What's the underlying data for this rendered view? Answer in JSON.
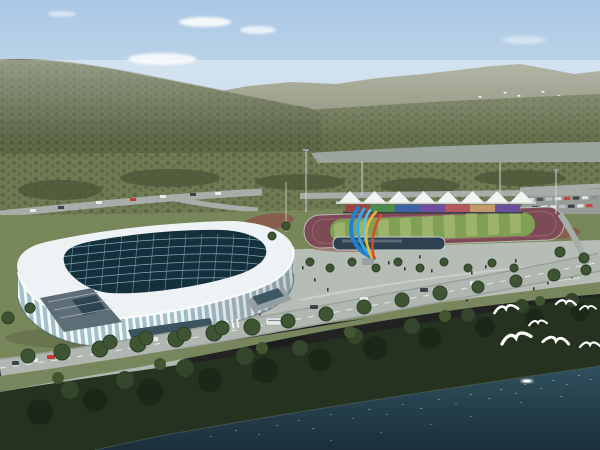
{
  "canvas": {
    "width": 600,
    "height": 450
  },
  "scene": {
    "description": "Aerial architectural rendering of a riverside sports complex: a white ribbed indoor arena with dark glass grid skylight, an outdoor athletics track with colorful grandstand and white tent canopies, a ribbon sculpture on a plaza, forested mountains behind, a river strip, dark shoreline trees and water in front with white birds",
    "clouds_count": 5,
    "distant_flock_count": 16,
    "foreground_birds_count": 7,
    "tents_count": 8,
    "seat_sections_count": 7
  },
  "athletics": {
    "seat_colors": [
      "#9e4340",
      "#4e8a4e",
      "#3f63a8",
      "#6f4fa0",
      "#b5575e",
      "#c09a68",
      "#6a4f9e"
    ]
  },
  "sculpture": {
    "blue_outer": "#1f7fd0",
    "blue_mid": "#36a6e0",
    "blue_inner": "#55c4ec",
    "yellow": "#f0b830",
    "red": "#d84a28"
  },
  "palette": {
    "sky_top": "#a9c7e5",
    "sky_mid": "#c9dcea",
    "sky_horizon": "#e6eae6",
    "cloud": "#ffffff",
    "mountain_far": "#8c9078",
    "mountain_near": "#5f6847",
    "mountain_dark": "#49533a",
    "foothill": "#67714d",
    "river": "#9aa69e",
    "orchard": "#6f7b53",
    "orchard_dark": "#4c5739",
    "lawn": "#78875a",
    "plaza": "#b6bcb6",
    "road": "#b0b6b0",
    "track": "#7c4b55",
    "field": "#7fa055",
    "field_stripe": "#9cb36c",
    "tent": "#f2f4f2",
    "arena_roof": "#edf2f4",
    "arena_glass": "#a3bfca",
    "arena_rib": "#f3f8f9",
    "skylight": "#14303c",
    "skylight_grid": "#7fa8b5",
    "pool": "#2e4150",
    "tree": "#3e5433",
    "tree_dark": "#2c3f27",
    "foreground_trees": "#25321f",
    "water_top": "#30505d",
    "water_bottom": "#1a2f3b",
    "sparkle": "#9fc6cf",
    "boat": "#f4f8f6",
    "bird": "#ffffff",
    "person": "#2e3338",
    "car_white": "#e8eae8",
    "car_red": "#c23b32",
    "car_dark": "#3a424a",
    "car_silver": "#b9bfc3"
  }
}
